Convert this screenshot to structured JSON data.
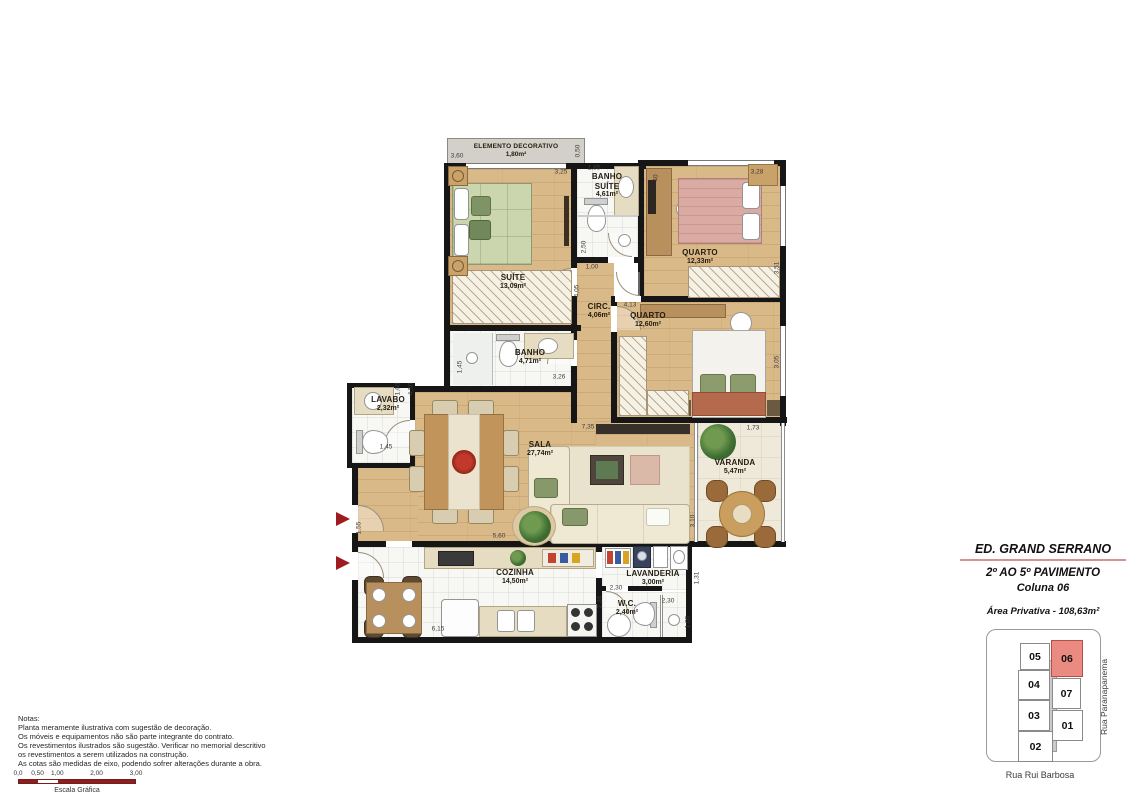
{
  "title_block": {
    "building": "ED. GRAND SERRANO",
    "floors": "2º AO 5º PAVIMENTO",
    "column": "Coluna 06",
    "private_area": "Área Privativa - 108,63m²"
  },
  "rooms": [
    {
      "id": "elemento-decorativo",
      "name": "ELEMENTO DECORATIVO",
      "area": "1,80m²",
      "x": 516,
      "y": 151,
      "cls": "sm"
    },
    {
      "id": "banho-suite",
      "name": "BANHO SUÍTE",
      "area": "4,61m²",
      "x": 607,
      "y": 186,
      "w": 42
    },
    {
      "id": "suite",
      "name": "SUÍTE",
      "area": "13,09m²",
      "x": 513,
      "y": 282
    },
    {
      "id": "quarto-1",
      "name": "QUARTO",
      "area": "12,33m²",
      "x": 700,
      "y": 257
    },
    {
      "id": "circ",
      "name": "CIRC.",
      "area": "4,06m²",
      "x": 599,
      "y": 311
    },
    {
      "id": "quarto-2",
      "name": "QUARTO",
      "area": "12,60m²",
      "x": 648,
      "y": 320
    },
    {
      "id": "banho",
      "name": "BANHO",
      "area": "4,71m²",
      "x": 530,
      "y": 357
    },
    {
      "id": "lavabo",
      "name": "LAVABO",
      "area": "2,32m²",
      "x": 388,
      "y": 404
    },
    {
      "id": "sala",
      "name": "SALA",
      "area": "27,74m²",
      "x": 540,
      "y": 449
    },
    {
      "id": "varanda",
      "name": "VARANDA",
      "area": "5,47m²",
      "x": 735,
      "y": 467
    },
    {
      "id": "cozinha",
      "name": "COZINHA",
      "area": "14,50m²",
      "x": 515,
      "y": 577
    },
    {
      "id": "lavanderia",
      "name": "LAVANDERIA",
      "area": "3,00m²",
      "x": 653,
      "y": 578
    },
    {
      "id": "wc",
      "name": "W.C.",
      "area": "2,40m²",
      "x": 627,
      "y": 608
    }
  ],
  "dimensions": [
    {
      "text": "3,60",
      "x": 457,
      "y": 156
    },
    {
      "text": "3,25",
      "x": 561,
      "y": 172
    },
    {
      "text": "1,85",
      "x": 594,
      "y": 168
    },
    {
      "text": "0,50",
      "x": 578,
      "y": 151,
      "v": true
    },
    {
      "text": "3,28",
      "x": 757,
      "y": 172
    },
    {
      "text": "40",
      "x": 656,
      "y": 178,
      "v": true
    },
    {
      "text": "2,50",
      "x": 584,
      "y": 247,
      "v": true
    },
    {
      "text": "1,00",
      "x": 592,
      "y": 267
    },
    {
      "text": "4,05",
      "x": 577,
      "y": 291,
      "v": true
    },
    {
      "text": "4,13",
      "x": 630,
      "y": 305
    },
    {
      "text": "3,51",
      "x": 777,
      "y": 268,
      "v": true
    },
    {
      "text": "3,05",
      "x": 777,
      "y": 362,
      "v": true
    },
    {
      "text": "1,45",
      "x": 460,
      "y": 367,
      "v": true
    },
    {
      "text": "3,26",
      "x": 559,
      "y": 377
    },
    {
      "text": "1,60",
      "x": 398,
      "y": 389,
      "v": true
    },
    {
      "text": "4,50",
      "x": 411,
      "y": 389,
      "v": true
    },
    {
      "text": "1,45",
      "x": 386,
      "y": 447
    },
    {
      "text": "7,35",
      "x": 588,
      "y": 427
    },
    {
      "text": "1,73",
      "x": 753,
      "y": 428
    },
    {
      "text": "3,10",
      "x": 693,
      "y": 521,
      "v": true
    },
    {
      "text": "5,60",
      "x": 499,
      "y": 536
    },
    {
      "text": "1,55",
      "x": 359,
      "y": 528,
      "v": true
    },
    {
      "text": "6,15",
      "x": 438,
      "y": 629
    },
    {
      "text": "2,30",
      "x": 616,
      "y": 588
    },
    {
      "text": "1,31",
      "x": 697,
      "y": 578,
      "v": true
    },
    {
      "text": "2,36",
      "x": 600,
      "y": 602,
      "v": true
    },
    {
      "text": "2,30",
      "x": 668,
      "y": 601
    },
    {
      "text": "1,05",
      "x": 688,
      "y": 622,
      "v": true
    }
  ],
  "notes": {
    "heading": "Notas:",
    "lines": [
      "Planta meramente ilustrativa com sugestão de decoração.",
      "Os móveis e equipamentos não são parte integrante do contrato.",
      "Os revestimentos ilustrados são sugestão. Verificar no memorial descritivo",
      "os revestimentos a serem utilizados na construção.",
      "As cotas são medidas de eixo, podendo sofrer alterações durante a obra."
    ]
  },
  "scale_bar": {
    "labels": [
      "0,0",
      "0,50",
      "1,00",
      "2,00",
      "3,00"
    ],
    "caption": "Escala Gráfica"
  },
  "keyplan": {
    "units": [
      {
        "id": "05",
        "x": 33,
        "y": 13,
        "w": 30,
        "h": 27
      },
      {
        "id": "06",
        "x": 64,
        "y": 10,
        "w": 32,
        "h": 37,
        "hl": true
      },
      {
        "id": "04",
        "x": 31,
        "y": 40,
        "w": 32,
        "h": 30
      },
      {
        "id": "07",
        "x": 65,
        "y": 48,
        "w": 29,
        "h": 31
      },
      {
        "id": "03",
        "x": 31,
        "y": 70,
        "w": 32,
        "h": 31
      },
      {
        "id": "01",
        "x": 65,
        "y": 80,
        "w": 31,
        "h": 31
      },
      {
        "id": "02",
        "x": 31,
        "y": 101,
        "w": 35,
        "h": 31
      }
    ],
    "streets": {
      "right": "Rua Paranapanema",
      "bottom": "Rua Rui Barbosa"
    }
  },
  "colors": {
    "accent_red": "#9e1b20",
    "keyplan_highlight": "#ea8a80",
    "title_divider_pink": "#d89090",
    "wall": "#161616",
    "wood_floor": "#dab988",
    "scale_bar_red": "#8b2020"
  }
}
